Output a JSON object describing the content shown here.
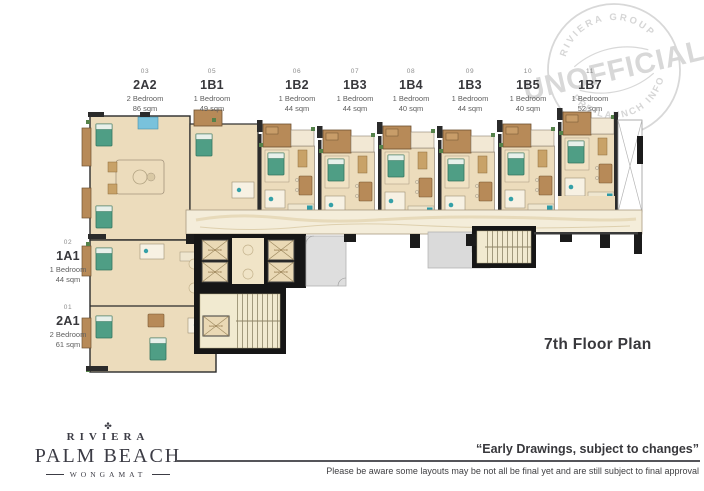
{
  "title": "7th Floor Plan",
  "watermark": {
    "top": "RIVIERA GROUP",
    "center": "UNOFFICIAL",
    "bottom": "PRE-LAUNCH INFO"
  },
  "units_top": [
    {
      "number": "03",
      "code": "2A2",
      "type": "2 Bedroom",
      "area": "86 sqm"
    },
    {
      "number": "05",
      "code": "1B1",
      "type": "1 Bedroom",
      "area": "49 sqm"
    },
    {
      "number": "06",
      "code": "1B2",
      "type": "1 Bedroom",
      "area": "44 sqm"
    },
    {
      "number": "07",
      "code": "1B3",
      "type": "1 Bedroom",
      "area": "44 sqm"
    },
    {
      "number": "08",
      "code": "1B4",
      "type": "1 Bedroom",
      "area": "40 sqm"
    },
    {
      "number": "09",
      "code": "1B3",
      "type": "1 Bedroom",
      "area": "44 sqm"
    },
    {
      "number": "10",
      "code": "1B5",
      "type": "1 Bedroom",
      "area": "40 sqm"
    },
    {
      "number": "11",
      "code": "1B7",
      "type": "1 Bedroom",
      "area": "52 sqm"
    }
  ],
  "units_left": [
    {
      "number": "02",
      "code": "1A1",
      "type": "1 Bedroom",
      "area": "44 sqm"
    },
    {
      "number": "01",
      "code": "2A1",
      "type": "2 Bedroom",
      "area": "61 sqm"
    }
  ],
  "plan": {
    "elevator_label": "ELEVATOR"
  },
  "logo": {
    "ornament": "✤",
    "brand": "RIVIERA",
    "name": "PALM BEACH",
    "location": "WONGAMAT"
  },
  "footer": {
    "quote": "“Early Drawings, subject to changes”",
    "disclaimer": "Please be aware some layouts may be not all be final yet and are still subject to final approval"
  },
  "colors": {
    "ink": "#38383c",
    "label_gray": "#8c8c8c",
    "muted": "#5f5f5f",
    "teal": "#4f9e85",
    "wood": "#b78a58",
    "floor": "#ecdcbc",
    "wall": "#2b2b2b",
    "stair": "#f1ead0",
    "watermark": "#d2d2d2",
    "rule": "#55555a"
  }
}
